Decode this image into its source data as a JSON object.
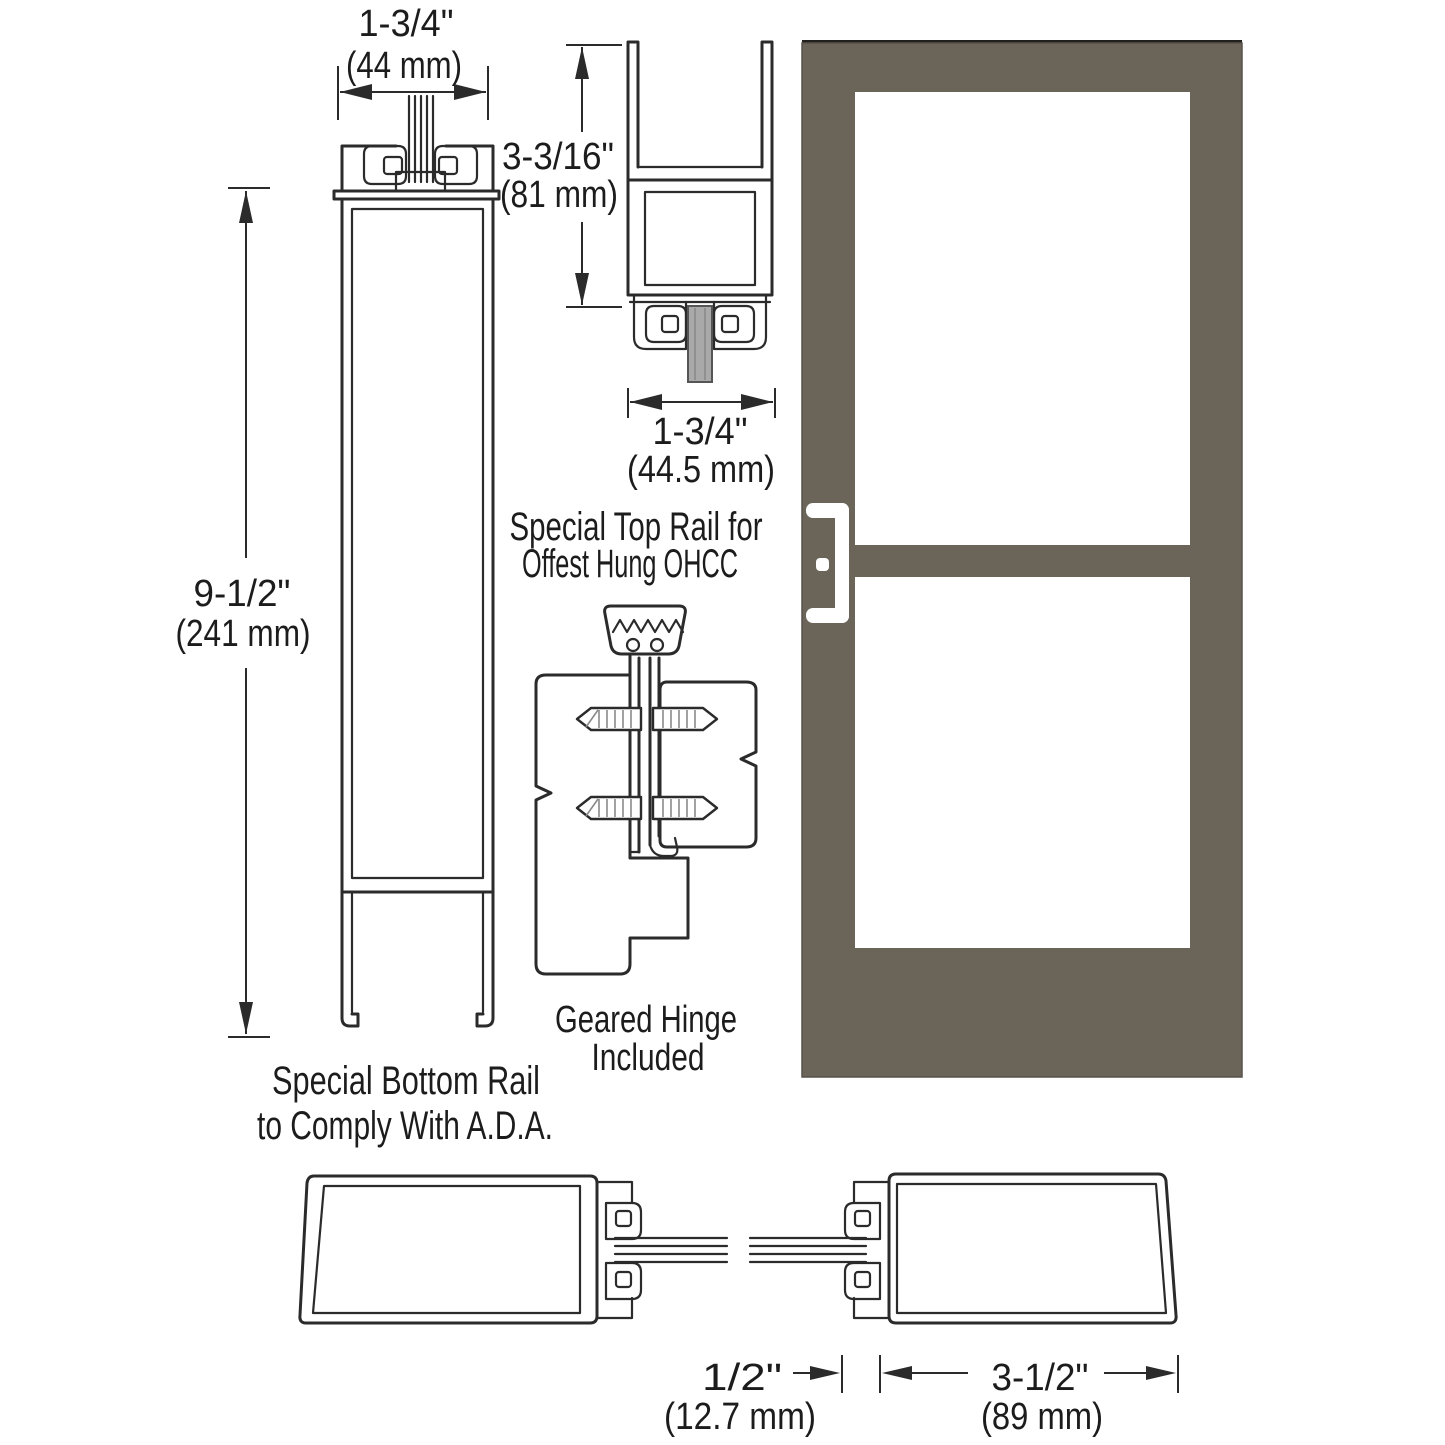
{
  "colors": {
    "background": "#ffffff",
    "line": "#2b2b2b",
    "door_bronze": "#6b6459",
    "door_top_edge": "#22201d",
    "glass_white": "#ffffff",
    "glass_gray": "#a9a9a9",
    "handle_white": "#ffffff"
  },
  "bottom_rail": {
    "width_in": "1-3/4\"",
    "width_mm": "(44 mm)",
    "height_in": "9-1/2\"",
    "height_mm": "(241 mm)",
    "caption_line1": "Special Bottom Rail",
    "caption_line2": "to Comply With A.D.A."
  },
  "top_rail": {
    "height_in": "3-3/16\"",
    "height_mm": "(81 mm)",
    "width_in": "1-3/4\"",
    "width_mm": "(44.5 mm)",
    "caption_line1": "Special Top Rail for",
    "caption_line2": "Offest Hung OHCC"
  },
  "hinge": {
    "caption_line1": "Geared Hinge",
    "caption_line2": "Included"
  },
  "bottom_sections": {
    "gap_in": "1/2\"",
    "gap_mm": "(12.7 mm)",
    "stile_in": "3-1/2\"",
    "stile_mm": "(89 mm)"
  }
}
